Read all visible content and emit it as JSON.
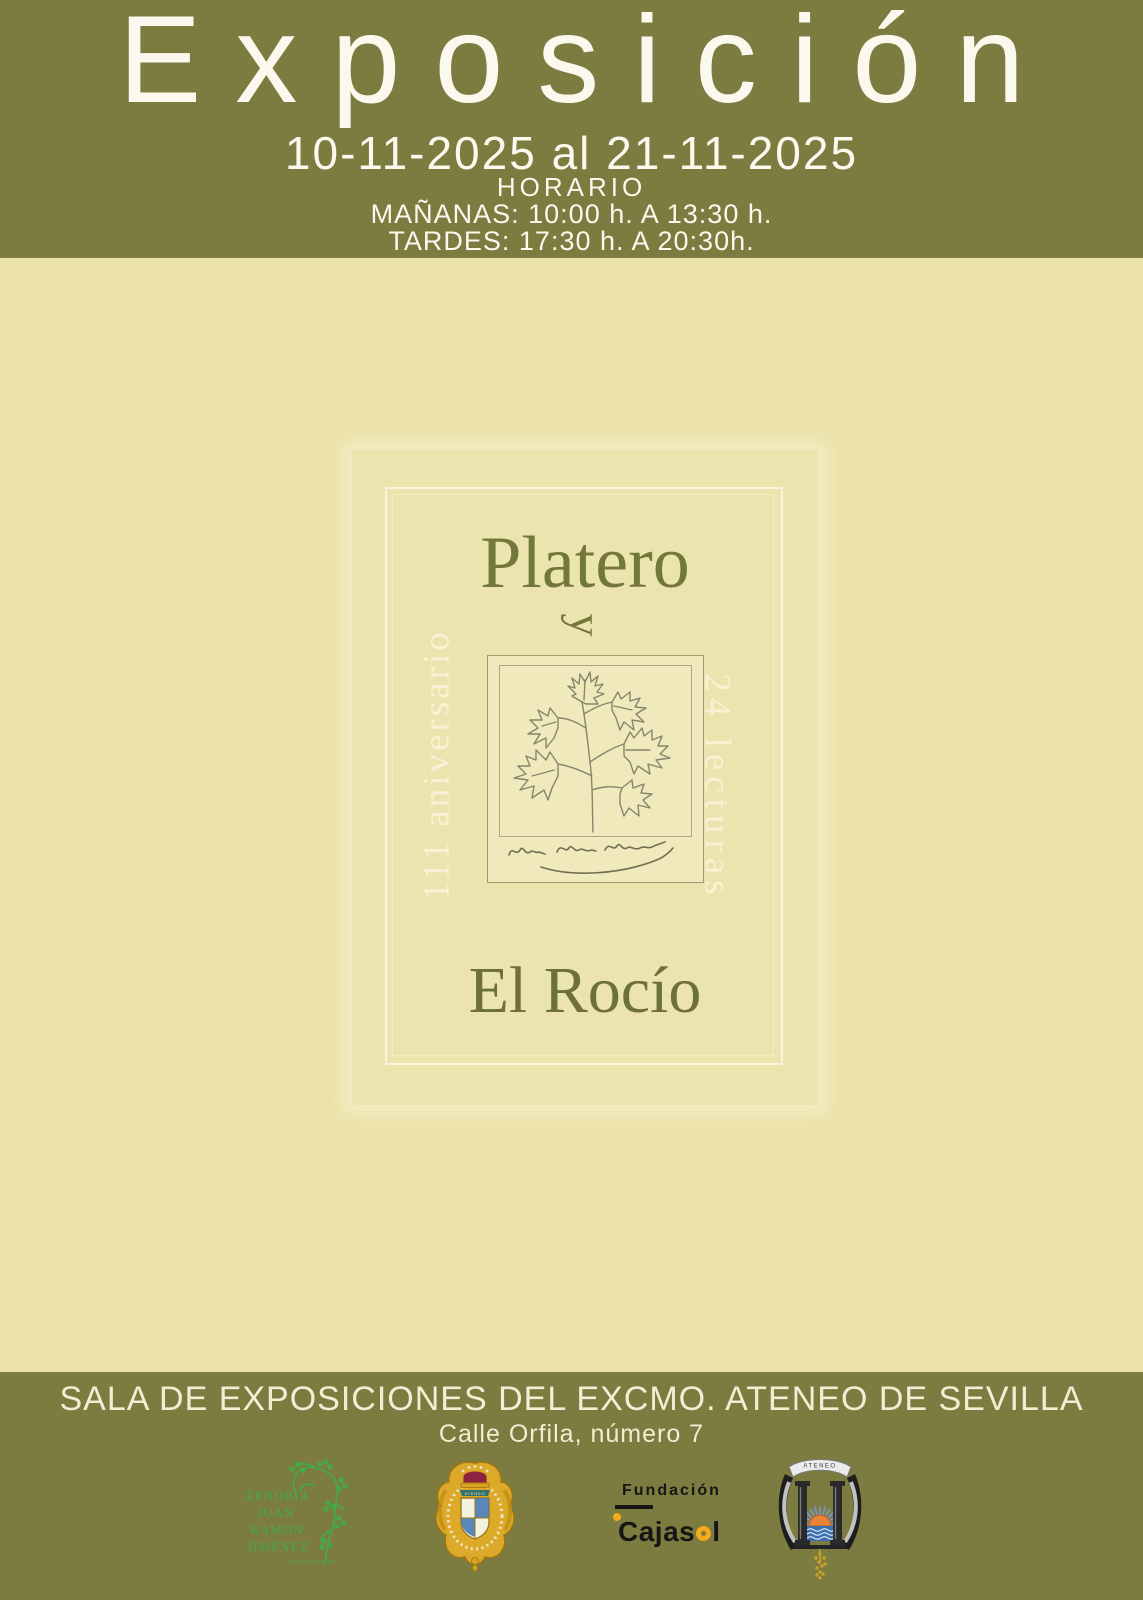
{
  "colors": {
    "olive_band": "#7c7b40",
    "cream_background": "#ebe2a7",
    "plate_background": "#ece4af",
    "frame_line": "#f9f4da",
    "header_text": "#fbf8ee",
    "artwork_olive_text": "#73773a",
    "vertical_text_cream": "#f8f2d5",
    "zenobia_green": "#3fae47",
    "cajasol_yellow": "#f5a91d",
    "crest_gold": "#dcaa28",
    "crown_red": "#8e2440",
    "sun_orange": "#e8833a",
    "sea_blue": "#3b6fae"
  },
  "header": {
    "title": "Exposición",
    "date_range": "10-11-2025 al 21-11-2025",
    "schedule_label": "HORARIO",
    "schedule_morning": "MAÑANAS: 10:00 h. A 13:30 h.",
    "schedule_afternoon": "TARDES: 17:30 h. A 20:30h."
  },
  "artwork": {
    "title": "Platero",
    "conjunction": "y",
    "subtitle": "El Rocío",
    "left_vertical_text": "111 aniversario",
    "right_vertical_text": "24 lecturas",
    "icons": {
      "plant": "parsley-sprig-sketch",
      "signature": "juan-ramon-jimenez-handwritten-signature"
    }
  },
  "footer": {
    "venue": "SALA DE EXPOSICIONES DEL EXCMO. ATENEO DE SEVILLA",
    "address": "Calle Orfila, número 7",
    "logos": {
      "zenobia": {
        "lines": [
          "ZENOBIA",
          "JUAN",
          "RAMÓN",
          "JIMÉNEZ"
        ],
        "sublabel": "FUNDACIÓN"
      },
      "ateneo_crest": {
        "banner": "ATENEO"
      },
      "cajasol": {
        "top": "Fundación",
        "brand_part1": "Cajas",
        "brand_part2": "l",
        "brand_full": "Cajasol"
      },
      "ateneo_sevilla": {
        "scroll": "ATENEO"
      }
    }
  }
}
